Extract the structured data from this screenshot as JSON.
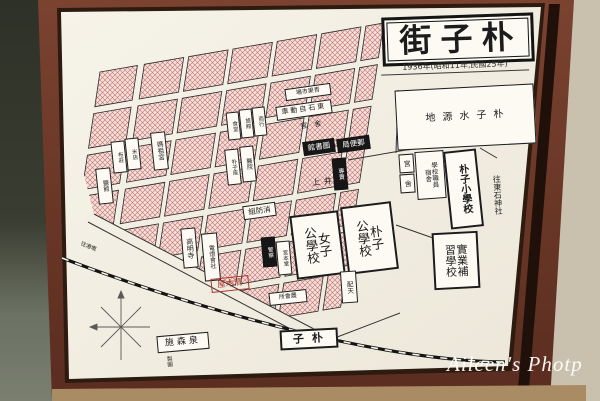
{
  "map": {
    "title": "街子朴",
    "subtitle": "1936年(昭和11年,民國25年)",
    "labels": {
      "water_source": "地源水子朴",
      "dorm_a": "宮",
      "dorm_b": "舍",
      "staff_dorm": "學校職員\n宿舍",
      "elementary": "朴子小學校",
      "shrine": "往東石神社",
      "vocational": "實業補\n習學校",
      "library": "館書圖",
      "post_office": "局便郵",
      "fire_brigade": "組防消",
      "girls_school": "女子\n公學校",
      "puzi_school": "朴子\n公學校",
      "temple_komyoji": "高明寺",
      "electric_co": "電燈會社",
      "kiyokiya": "屋木清",
      "station": "子朴",
      "shimori": "施森泉",
      "to_gangqian": "往港墘",
      "haitian": "配天",
      "kamii": "上井",
      "monopoly": "專賣",
      "police": "警察",
      "miyamoto": "宮本堂",
      "bus_co": "車動自石東",
      "kansha": "官　舍",
      "market": "場市果青",
      "shop1": "食堂",
      "shop2": "旅館",
      "shop3": "商行",
      "theater": "朴子座",
      "hospital": "醫院",
      "shop4": "布莊",
      "shop5": "米店",
      "shop6": "鹽館",
      "mazu_temple": "媽祖宮",
      "nokai": "所會農",
      "seizu": "製圖"
    }
  },
  "watermark": "Aileen's Photp"
}
